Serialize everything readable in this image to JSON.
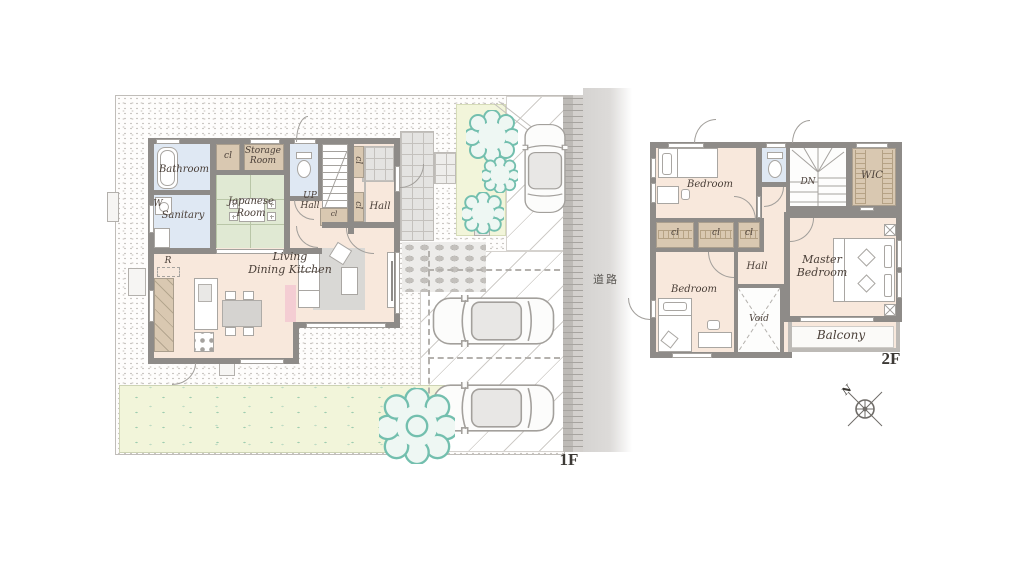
{
  "palette": {
    "wall": "#8e8b88",
    "floor": "#f8e8dc",
    "tatami_green": "#e0e9d3",
    "wet_area_blue": "#dfe8f3",
    "closet_tan": "#d9c8b1",
    "accent_pink": "#f4cdd3",
    "tree_teal": "#73bfae",
    "grass": "#f2f5da",
    "road_gray": "#d5d3d1",
    "label_ink": "#4a3f38"
  },
  "floor1": {
    "floor_label": "1F",
    "road_label": "道路",
    "rooms": {
      "bathroom": "Bathroom",
      "washer_mark": "W",
      "sanitary": "Sanitary",
      "closet_top": "cl",
      "storage": {
        "line1": "Storage",
        "line2": "Room"
      },
      "japanese": {
        "line1": "Japanese",
        "line2": "Room"
      },
      "stair_hall": {
        "line1": "UP",
        "line2": "Hall"
      },
      "closet_under_stairs": "cl",
      "closet_entry_upper": "cl",
      "closet_entry_lower": "cl",
      "entry_hall": "Hall",
      "refrigerator_mark": "R",
      "ldk": {
        "line1": "Living",
        "line2": "Dining Kitchen"
      }
    }
  },
  "floor2": {
    "floor_label": "2F",
    "rooms": {
      "bedroom_north": "Bedroom",
      "stairs_down": "DN",
      "walk_in_closet": "WIC",
      "closet_left": "cl",
      "closet_mid": "cl",
      "closet_right": "cl",
      "bedroom_south": "Bedroom",
      "hall": "Hall",
      "void": "Void",
      "master_bedroom": {
        "line1": "Master",
        "line2": "Bedroom"
      },
      "balcony": "Balcony"
    }
  },
  "compass": {
    "north": "N"
  }
}
